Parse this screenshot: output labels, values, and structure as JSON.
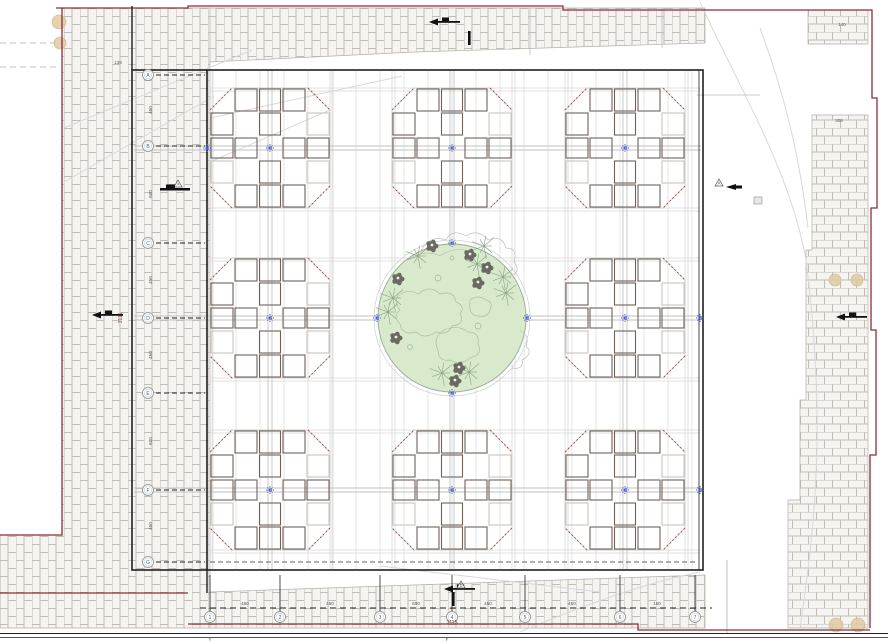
{
  "title": "Courtyard pavilion site plan with central garden",
  "colors": {
    "boundary_red": "#8a2f38",
    "plan_black": "#1f1f1f",
    "brick_fill": "#f5f4f1",
    "brick_line": "#c0bcb6",
    "area_edge": "#b3b0aa",
    "grid_minor": "#dcdcdc",
    "grid_major": "#c2c2c2",
    "module_dark": "#6e6259",
    "module_light": "#c9c4bd",
    "octagon_corner_red": "#b05050",
    "octagon_edge": "#c6c6c6",
    "garden_fill": "#d8e9cc",
    "garden_stroke": "#9aa99a",
    "contour_green": "#a9c09e",
    "contour_gray": "#bdbdbd",
    "tree_dark": "#6a6a60",
    "starburst_green": "#8aa383",
    "marker_blue": "#4d5ed1",
    "beige": "#dfcaa2",
    "dim_text": "#555555",
    "bubble_text": "#3a6b7d",
    "total_dim_text": "#8a4a4a",
    "road_gray": "#d8d8d8"
  },
  "plan": {
    "border": [
      132,
      70,
      703,
      570
    ],
    "inner_edge_x": 207,
    "module_centers": [
      [
        270,
        148
      ],
      [
        452,
        148
      ],
      [
        625,
        148
      ],
      [
        270,
        318
      ],
      [
        625,
        318
      ],
      [
        270,
        490
      ],
      [
        452,
        490
      ],
      [
        625,
        490
      ]
    ],
    "module_half": 60,
    "module_cell": 24,
    "module_dark_cells": [
      [
        0,
        -2
      ],
      [
        0,
        -1
      ],
      [
        0,
        1
      ],
      [
        0,
        2
      ],
      [
        -2,
        0
      ],
      [
        -1,
        0
      ],
      [
        1,
        0
      ],
      [
        2,
        0
      ],
      [
        -1,
        -2
      ],
      [
        -2,
        -1
      ],
      [
        1,
        -2
      ],
      [
        1,
        2
      ],
      [
        -1,
        2
      ]
    ],
    "module_light_cells": [
      [
        2,
        -1
      ],
      [
        -2,
        1
      ],
      [
        2,
        1
      ]
    ],
    "garden": {
      "cx": 452,
      "cy": 318,
      "r": 74,
      "r_outer": 78
    },
    "grid_minor_x_start": 212,
    "grid_minor_x_end": 698,
    "grid_minor_step": 24,
    "grid_edge_cols": [
      210,
      330,
      392,
      512,
      565,
      685
    ],
    "grid_edge_rows": [
      88,
      208,
      258,
      378,
      430,
      550
    ]
  },
  "grid_bubbles_left": {
    "x": 148,
    "items": [
      {
        "label": "A",
        "y": 75
      },
      {
        "label": "B",
        "y": 146
      },
      {
        "label": "C",
        "y": 243
      },
      {
        "label": "D",
        "y": 318
      },
      {
        "label": "E",
        "y": 393
      },
      {
        "label": "F",
        "y": 490
      },
      {
        "label": "G",
        "y": 562
      }
    ]
  },
  "grid_bubbles_bottom": {
    "y": 617,
    "items": [
      {
        "label": "1",
        "x": 210
      },
      {
        "label": "2",
        "x": 280
      },
      {
        "label": "3",
        "x": 380
      },
      {
        "label": "4",
        "x": 452
      },
      {
        "label": "5",
        "x": 525
      },
      {
        "label": "6",
        "x": 620
      },
      {
        "label": "7",
        "x": 695
      }
    ]
  },
  "dims_left": {
    "x": 152,
    "items": [
      {
        "value": "450",
        "y": 110
      },
      {
        "value": "600",
        "y": 194
      },
      {
        "value": "450",
        "y": 280
      },
      {
        "value": "450",
        "y": 355
      },
      {
        "value": "600",
        "y": 441
      },
      {
        "value": "450",
        "y": 526
      }
    ],
    "total": {
      "value": "3115",
      "x": 122,
      "y": 318
    }
  },
  "dims_bottom": {
    "y": 605,
    "items": [
      {
        "value": "450",
        "x": 245
      },
      {
        "value": "450",
        "x": 330
      },
      {
        "value": "600",
        "x": 416
      },
      {
        "value": "450",
        "x": 488
      },
      {
        "value": "450",
        "x": 572
      },
      {
        "value": "150",
        "x": 657
      }
    ],
    "total": {
      "value": "3115",
      "x": 452,
      "y": 624
    }
  },
  "section_markers": {
    "a_label": "A",
    "b_label": "B"
  },
  "misc_texts": [
    {
      "t": "138",
      "x": 118,
      "y": 64
    },
    {
      "t": "140",
      "x": 842,
      "y": 26
    },
    {
      "t": "308",
      "x": 839,
      "y": 122
    },
    {
      "t": "Y",
      "x": 210,
      "y": 641
    },
    {
      "t": "F",
      "x": 447,
      "y": 641
    }
  ],
  "garden_features": {
    "tree_blobs": [
      [
        470,
        255
      ],
      [
        487,
        268
      ],
      [
        478,
        283
      ],
      [
        398,
        279
      ],
      [
        396,
        338
      ],
      [
        459,
        368
      ],
      [
        455,
        381
      ],
      [
        432,
        246
      ]
    ],
    "starbursts": [
      [
        477,
        264
      ],
      [
        503,
        277
      ],
      [
        506,
        293
      ],
      [
        393,
        298
      ],
      [
        388,
        312
      ],
      [
        442,
        373
      ],
      [
        469,
        372
      ],
      [
        418,
        256
      ],
      [
        484,
        246
      ]
    ],
    "small_circles": [
      [
        438,
        278,
        3
      ],
      [
        478,
        326,
        3
      ],
      [
        410,
        347,
        2.4
      ],
      [
        452,
        258,
        2
      ]
    ]
  },
  "beige_circles": [
    [
      59,
      22,
      7
    ],
    [
      60,
      43,
      6
    ],
    [
      835,
      280,
      6
    ],
    [
      857,
      280,
      6
    ],
    [
      836,
      625,
      7
    ],
    [
      858,
      625,
      7
    ]
  ],
  "point_markers": [
    [
      270,
      148
    ],
    [
      452,
      148
    ],
    [
      625,
      148
    ],
    [
      270,
      318
    ],
    [
      625,
      318
    ],
    [
      270,
      490
    ],
    [
      452,
      490
    ],
    [
      625,
      490
    ],
    [
      452,
      243
    ],
    [
      452,
      393
    ],
    [
      377,
      318
    ],
    [
      527,
      318
    ],
    [
      207,
      148
    ],
    [
      700,
      318
    ],
    [
      700,
      490
    ]
  ],
  "spot_arrows": [
    {
      "x": 429,
      "y": 22,
      "dir": "left"
    },
    {
      "x": 92,
      "y": 315,
      "dir": "left"
    },
    {
      "x": 836,
      "y": 317,
      "dir": "left"
    },
    {
      "x": 444,
      "y": 589,
      "dir": "left"
    }
  ],
  "level_bars": [
    [
      468,
      31
    ],
    [
      452,
      592
    ]
  ],
  "icons": [
    "point-marker-icon",
    "tree-icon",
    "starburst-tree-icon",
    "section-triangle-icon",
    "spot-arrow-icon",
    "grid-bubble"
  ]
}
